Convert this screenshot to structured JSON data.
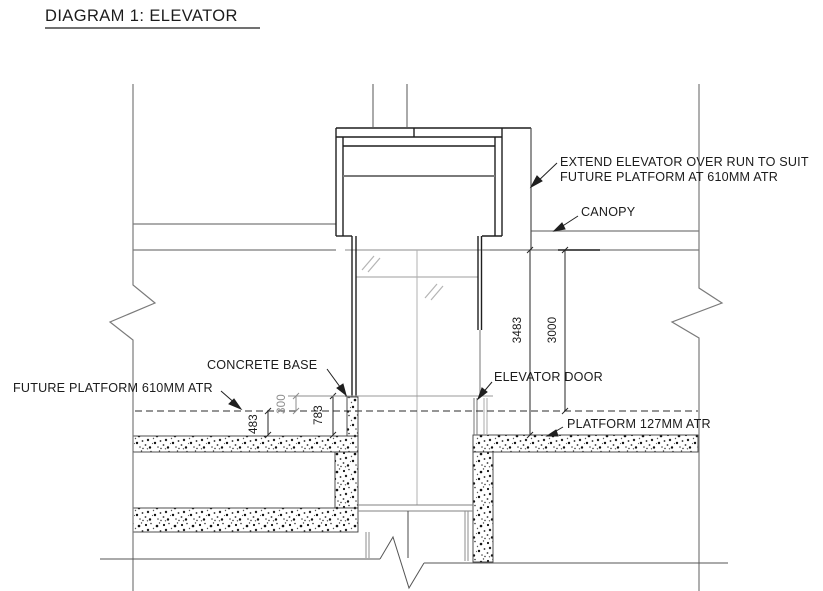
{
  "title": "DIAGRAM 1: ELEVATOR",
  "labels": {
    "extend_overrun_line1": "EXTEND ELEVATOR OVER RUN TO SUIT",
    "extend_overrun_line2": "FUTURE PLATFORM AT 610MM ATR",
    "canopy": "CANOPY",
    "concrete_base": "CONCRETE BASE",
    "elevator_door": "ELEVATOR DOOR",
    "future_platform": "FUTURE PLATFORM 610MM ATR",
    "platform": "PLATFORM 127MM ATR"
  },
  "dimensions": {
    "overrun_to_platform": "3483",
    "canopy_to_future_platform": "3000",
    "base_above_future_platform": "300",
    "base_total_height": "783",
    "future_to_existing_platform": "483"
  },
  "colors": {
    "line_dark": "#1f1f1f",
    "line_gray": "#7a7a7a",
    "line_light": "#a8a8a8",
    "background": "#ffffff"
  }
}
